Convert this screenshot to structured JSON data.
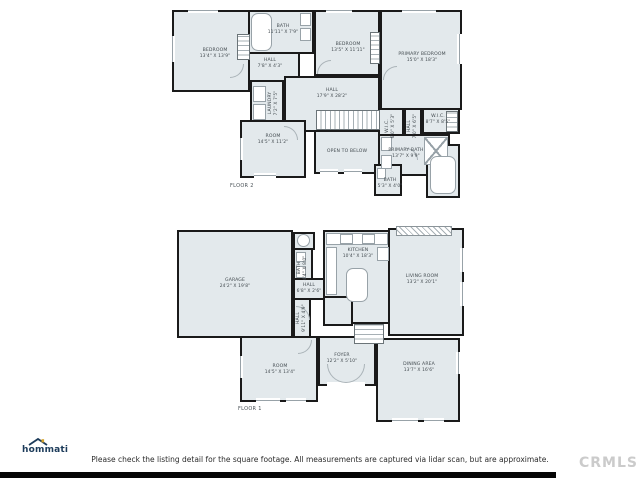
{
  "page": {
    "disclaimer": "Please check the listing detail for the square footage. All measurements are captured via lidar scan, but are approximate.",
    "watermark": "CRMLS",
    "logo": {
      "text": "hommati"
    },
    "colors": {
      "room_fill": "#e3e9ec",
      "wall": "#1a1a1a",
      "logo_navy": "#1c3b5a",
      "logo_gold": "#d5a32b",
      "watermark_gray": "#cbcbcb"
    }
  },
  "floors": [
    {
      "caption": "FLOOR 2",
      "rooms": [
        {
          "name": "BEDROOM",
          "dims": "13'4\" X 13'9\""
        },
        {
          "name": "BATH",
          "dims": "11'11\" X 7'9\""
        },
        {
          "name": "HALL",
          "dims": "7'8\" X 4'3\""
        },
        {
          "name": "BEDROOM",
          "dims": "13'5\" X 11'11\""
        },
        {
          "name": "PRIMARY BEDROOM",
          "dims": "15'0\" X 18'3\""
        },
        {
          "name": "LAUNDRY",
          "dims": "7'2\" X 7'5\""
        },
        {
          "name": "HALL",
          "dims": "17'9\" X 28'2\""
        },
        {
          "name": "ROOM",
          "dims": "14'5\" X 11'2\""
        },
        {
          "name": "OPEN TO BELOW",
          "dims": ""
        },
        {
          "name": "W.I.C.",
          "dims": "6'0\" X 5'3\""
        },
        {
          "name": "HALL",
          "dims": "7'0\" X 6'5\""
        },
        {
          "name": "W.I.C.",
          "dims": "8'7\" X 8'5\""
        },
        {
          "name": "PRIMARY BATH",
          "dims": "13'7\" X 9'9\""
        },
        {
          "name": "BATH",
          "dims": "5'3\" X 4'0\""
        }
      ]
    },
    {
      "caption": "FLOOR 1",
      "rooms": [
        {
          "name": "GARAGE",
          "dims": "24'2\" X 19'8\""
        },
        {
          "name": "BATH",
          "dims": "4'4\" X 8'0\""
        },
        {
          "name": "HALL",
          "dims": "6'8\" X 2'6\""
        },
        {
          "name": "KITCHEN",
          "dims": "10'4\" X 18'3\""
        },
        {
          "name": "LIVING ROOM",
          "dims": "13'2\" X 20'1\""
        },
        {
          "name": "HALL",
          "dims": "9'11\" X 4'9\""
        },
        {
          "name": "ROOM",
          "dims": "14'5\" X 13'4\""
        },
        {
          "name": "FOYER",
          "dims": "12'2\" X 5'10\""
        },
        {
          "name": "DINING AREA",
          "dims": "13'7\" X 16'6\""
        }
      ]
    }
  ]
}
